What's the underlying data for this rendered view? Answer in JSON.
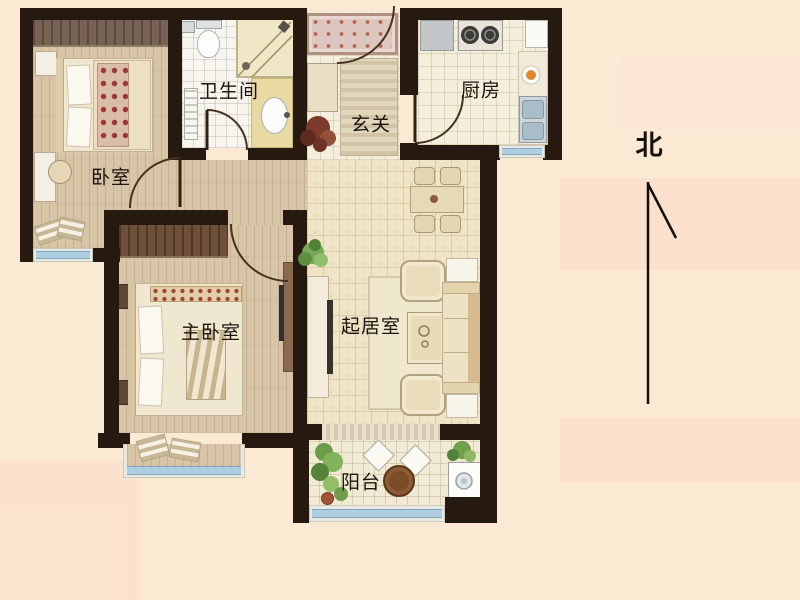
{
  "plan": {
    "type": "apartment-floor-plan",
    "rooms": [
      {
        "id": "bedroom",
        "label": "卧室"
      },
      {
        "id": "bathroom",
        "label": "卫生间"
      },
      {
        "id": "entry",
        "label": "玄关"
      },
      {
        "id": "kitchen",
        "label": "厨房"
      },
      {
        "id": "master_bedroom",
        "label": "主卧室"
      },
      {
        "id": "living_room",
        "label": "起居室"
      },
      {
        "id": "balcony",
        "label": "阳台"
      }
    ],
    "compass": {
      "north_label": "北"
    },
    "palette": {
      "background": "#fbe9d4",
      "wall": "#261a10",
      "wood_floor": "#d8c4a6",
      "tile_floor": "#efe4c5",
      "window_glass": "#aecfe2",
      "label_color": "#1b140d"
    }
  }
}
